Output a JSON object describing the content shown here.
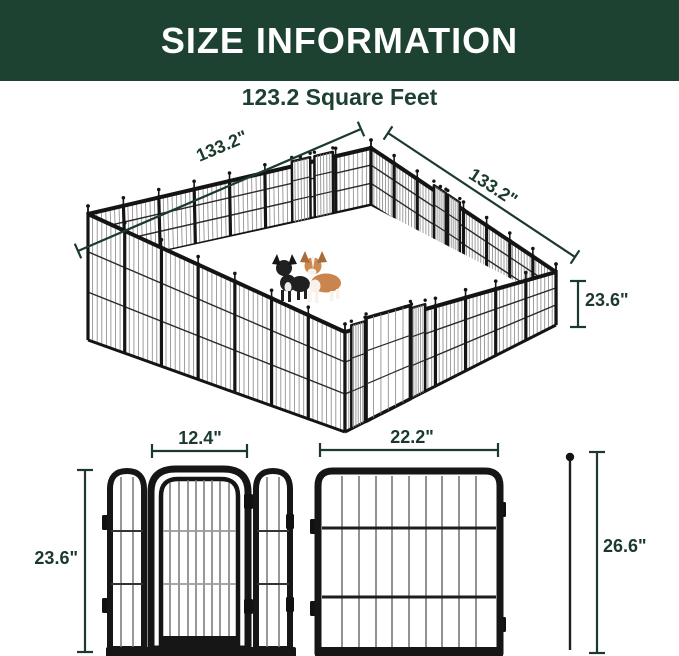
{
  "header": {
    "title": "SIZE INFORMATION"
  },
  "subtitle": "123.2 Square Feet",
  "pen_diagram": {
    "dim_top_left_width": "133.2\"",
    "dim_top_right_width": "133.2\"",
    "dim_panel_height": "23.6\"",
    "contents": [
      "french-bulldog-icon",
      "corgi-icon"
    ]
  },
  "panel_diagrams": {
    "door_panel_width": "12.4\"",
    "door_panel_height": "23.6\"",
    "regular_panel_width": "22.2\"",
    "stake_height": "26.6\""
  },
  "colors": {
    "banner_green": "#1d4232",
    "dimension_green": "#1b3a2c",
    "fence_black": "#161616",
    "corgi_tan": "#c9854d"
  }
}
